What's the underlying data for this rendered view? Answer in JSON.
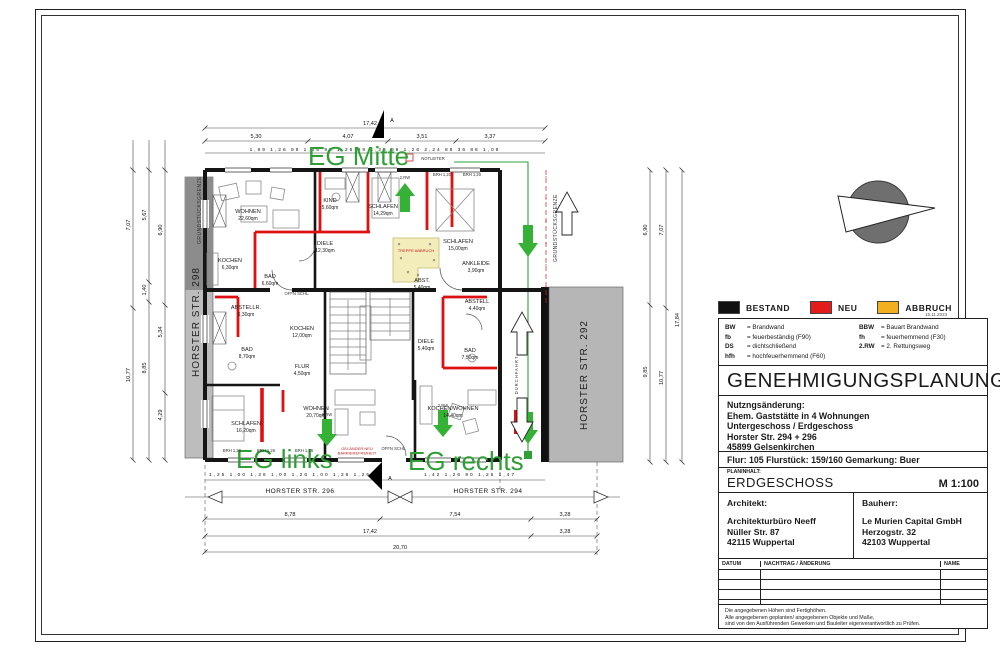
{
  "legend": {
    "items": [
      {
        "label": "BESTAND",
        "color": "#111111"
      },
      {
        "label": "NEU",
        "color": "#e31b1b"
      },
      {
        "label": "ABBRUCH",
        "color": "#f2b01e"
      }
    ],
    "date": "15.11.2023"
  },
  "abbr": {
    "col1": [
      {
        "abbr": "BW",
        "text": "= Brandwand"
      },
      {
        "abbr": "fb",
        "text": "= feuerbeständig (F90)"
      },
      {
        "abbr": "DS",
        "text": "= dichtschließend"
      },
      {
        "abbr": "hfh",
        "text": "= hochfeuerhemmend (F60)"
      }
    ],
    "col2": [
      {
        "abbr": "BBW",
        "text": "= Bauart Brandwand"
      },
      {
        "abbr": "fh",
        "text": "= feuerhemmend (F30)"
      },
      {
        "abbr": "2.RW",
        "text": "= 2. Rettungsweg"
      }
    ]
  },
  "tb": {
    "title": "GENEHMIGUNGSPLANUNG",
    "usage_lines": [
      "Nutzngsänderung:",
      "Ehem. Gaststätte in 4 Wohnungen",
      "Untergeschoss / Erdgeschoss",
      "Horster Str. 294 + 296",
      "45899 Gelsenkirchen"
    ],
    "parcel": "Flur: 105 Flurstück: 159/160   Gemarkung: Buer",
    "planinhalt_label": "PLANINHALT:",
    "plan_content": "ERDGESCHOSS",
    "scale": "M 1:100",
    "architect_label": "Architekt:",
    "architect_lines": [
      "Architekturbüro Neeff",
      "Nüller Str. 87",
      "42115 Wuppertal"
    ],
    "client_label": "Bauherr:",
    "client_lines": [
      "Le Murien Capital GmbH",
      "Herzogstr. 32",
      "42103 Wuppertal"
    ],
    "table_headers": [
      "DATUM",
      "NACHTRAG / ÄNDERUNG",
      "NAME"
    ],
    "notes": [
      "Die angegebenen Höhen sind Fertighöhen.",
      "Alle angegebenen geplanten/ angegebenen Objekte und Maße,",
      "sind von den Ausführenden Gewerken und Bauleiter eigenverantwortlich zu Prüfen."
    ]
  },
  "plan": {
    "units": {
      "mitte": "EG Mitte",
      "links": "EG links",
      "rechts": "EG rechts"
    },
    "rooms": [
      {
        "name": "WOHNEN",
        "area": "22,60qm"
      },
      {
        "name": "KIND",
        "area": "5,60qm"
      },
      {
        "name": "SCHLAFEN",
        "area": "14,29qm"
      },
      {
        "name": "SCHLAFEN",
        "area": "15,00qm"
      },
      {
        "name": "ANKLEIDE",
        "area": "3,90qm"
      },
      {
        "name": "DIELE",
        "area": "12,30qm"
      },
      {
        "name": "KOCHEN",
        "area": "6,30qm"
      },
      {
        "name": "BAD",
        "area": "6,60qm"
      },
      {
        "name": "ABST.",
        "area": "5,40qm"
      },
      {
        "name": "ABSTELL",
        "area": "4,40qm"
      },
      {
        "name": "BAD",
        "area": "7,50qm"
      },
      {
        "name": "DIELE",
        "area": "5,40qm"
      },
      {
        "name": "ABSTELLR.",
        "area": "6,30qm"
      },
      {
        "name": "BAD",
        "area": "8,70qm"
      },
      {
        "name": "KOCHEN",
        "area": "12,00qm"
      },
      {
        "name": "FLUR",
        "area": "4,50qm"
      },
      {
        "name": "SCHLAFEN",
        "area": "16,20qm"
      },
      {
        "name": "WOHNEN",
        "area": "20,70qm"
      },
      {
        "name": "KOCHEN/WOHNEN",
        "area": "14,40qm"
      }
    ],
    "annotations": {
      "notleiter": "NOTLEITER",
      "durchfahrt": "DURCHFAHRT",
      "treppe_abbruch": "TREPPE ABBRUCH",
      "rettungsweg": "2.RW",
      "grenze": "GRUNDSTÜCKSGRENZE",
      "offen": "OFFN SCHL.",
      "brh_120": "BRH 1,20",
      "brh_126": "BRH 1,26",
      "gelaender": "GELÄNDER NEU",
      "barrierefrei": "BARRIEREFREIHEIT"
    },
    "streets": {
      "left": "HORSTER STR. 298",
      "right": "HORSTER STR. 292",
      "bottom_left": "HORSTER STR. 296",
      "bottom_right": "HORSTER STR. 294"
    },
    "section_marker": "A",
    "dims": {
      "top_total": "17,42",
      "top_row": [
        "5,30",
        "4,07",
        "3,51",
        "3,37"
      ],
      "top_small": "1,69 1,26 99 1,26 99 1,26 99 1,26 99 1,26 2,24 88 36 88 1,09",
      "bottom_small_left": "1,25 1,00 1,26 1,00 1,26 1,00 1,26 1,25",
      "bottom_small_right": "1,42 1,26 90 1,26 1,47",
      "bottom_row1": [
        "8,78",
        "7,54",
        "3,28"
      ],
      "bottom_row2": [
        "17,42",
        "3,28"
      ],
      "bottom_total": "20,70",
      "left_outer": [
        "7,07",
        "10,77"
      ],
      "left_mid": [
        "5,67",
        "1,40",
        "8,85"
      ],
      "left_inner": [
        "6,90",
        "5,34",
        "4,29"
      ],
      "right_inner": [
        "6,90",
        "9,85"
      ],
      "right_mid": [
        "7,07",
        "10,77"
      ],
      "right_total": "17,84"
    }
  }
}
